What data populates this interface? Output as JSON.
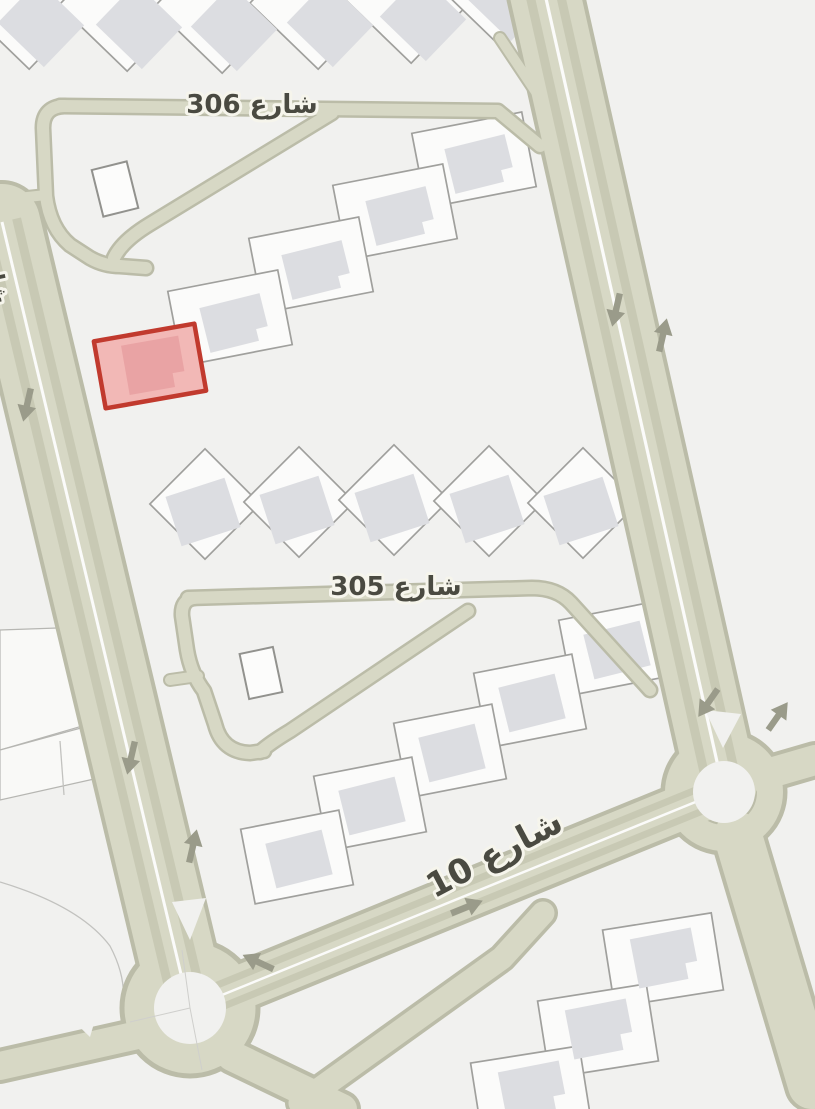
{
  "map": {
    "type": "street-map-tile",
    "labels": {
      "street_306": "شارع 306",
      "street_305": "شارع 305",
      "street_10": "شارع 10",
      "partial_left_edge": "شارع"
    },
    "highlighted_parcel": {
      "name": "selected-plot",
      "stroke": "#c13a2e",
      "fill": "#f2b8b6"
    },
    "colors": {
      "background": "#f1f1ef",
      "road": "#d7d8c5",
      "road_casing": "#bbbca8",
      "road_stripe": "#c8c9b4",
      "road_median": "#ffffff",
      "parcel_fill": "#fbfbfa",
      "parcel_stroke": "#a0a09d",
      "building_fill": "#dcdde1",
      "highlight_stroke": "#c13a2e",
      "highlight_fill": "#f2b8b6",
      "highlight_building": "#e9a3a4",
      "label_text": "#4a4a41",
      "label_halo": "#f6f5ec",
      "arrow": "#9a9b8a"
    }
  }
}
